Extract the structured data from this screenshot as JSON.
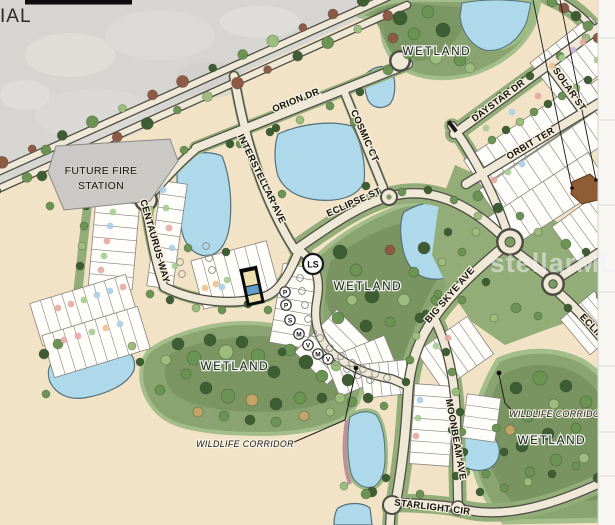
{
  "edge_text_partial": "IAL",
  "watermark": "stellarMLS",
  "parcels": {
    "future_fire_station_line1": "FUTURE FIRE",
    "future_fire_station_line2": "STATION"
  },
  "streets": {
    "orion": "ORION DR",
    "cosmic": "COSMIC CT",
    "interstellar": "INTERSTELLAR AVE",
    "eclipse": "ECLIPSE ST",
    "eclipse_edge": "ECLIPSE",
    "centaurus": "CENTAURUS WAY",
    "daystar": "DAYSTAR DR",
    "solar": "SOLAR ST",
    "orbit": "ORBIT TER",
    "big_skye": "BIG SKYE AVE",
    "moonbeam": "MOONBEAM AVE",
    "starlight": "STARLIGHT CIR"
  },
  "area_labels": {
    "wetland": "WETLAND",
    "wildlife_corridor": "WILDLIFE CORRIDOR"
  },
  "markers": {
    "lift_station": "LS",
    "lot_types": [
      "P",
      "P",
      "S",
      "M",
      "V",
      "M",
      "V"
    ]
  },
  "colors": {
    "land": "#f2e3c6",
    "industrial": "#d7d5d2",
    "water": "#aed9eb",
    "wetland": "#8aa471",
    "wetland_dark": "#74905c",
    "turf": "#93ad78",
    "road": "#efe8d6",
    "road_edge": "#4f4e46",
    "highlight_lot": "#0a0a0a",
    "dot_pink": "#e7a8a3",
    "dot_green": "#a6cb90",
    "dot_blue": "#abcfe6",
    "dot_orange": "#e9c48e",
    "dot_purple": "#c9b4da"
  }
}
